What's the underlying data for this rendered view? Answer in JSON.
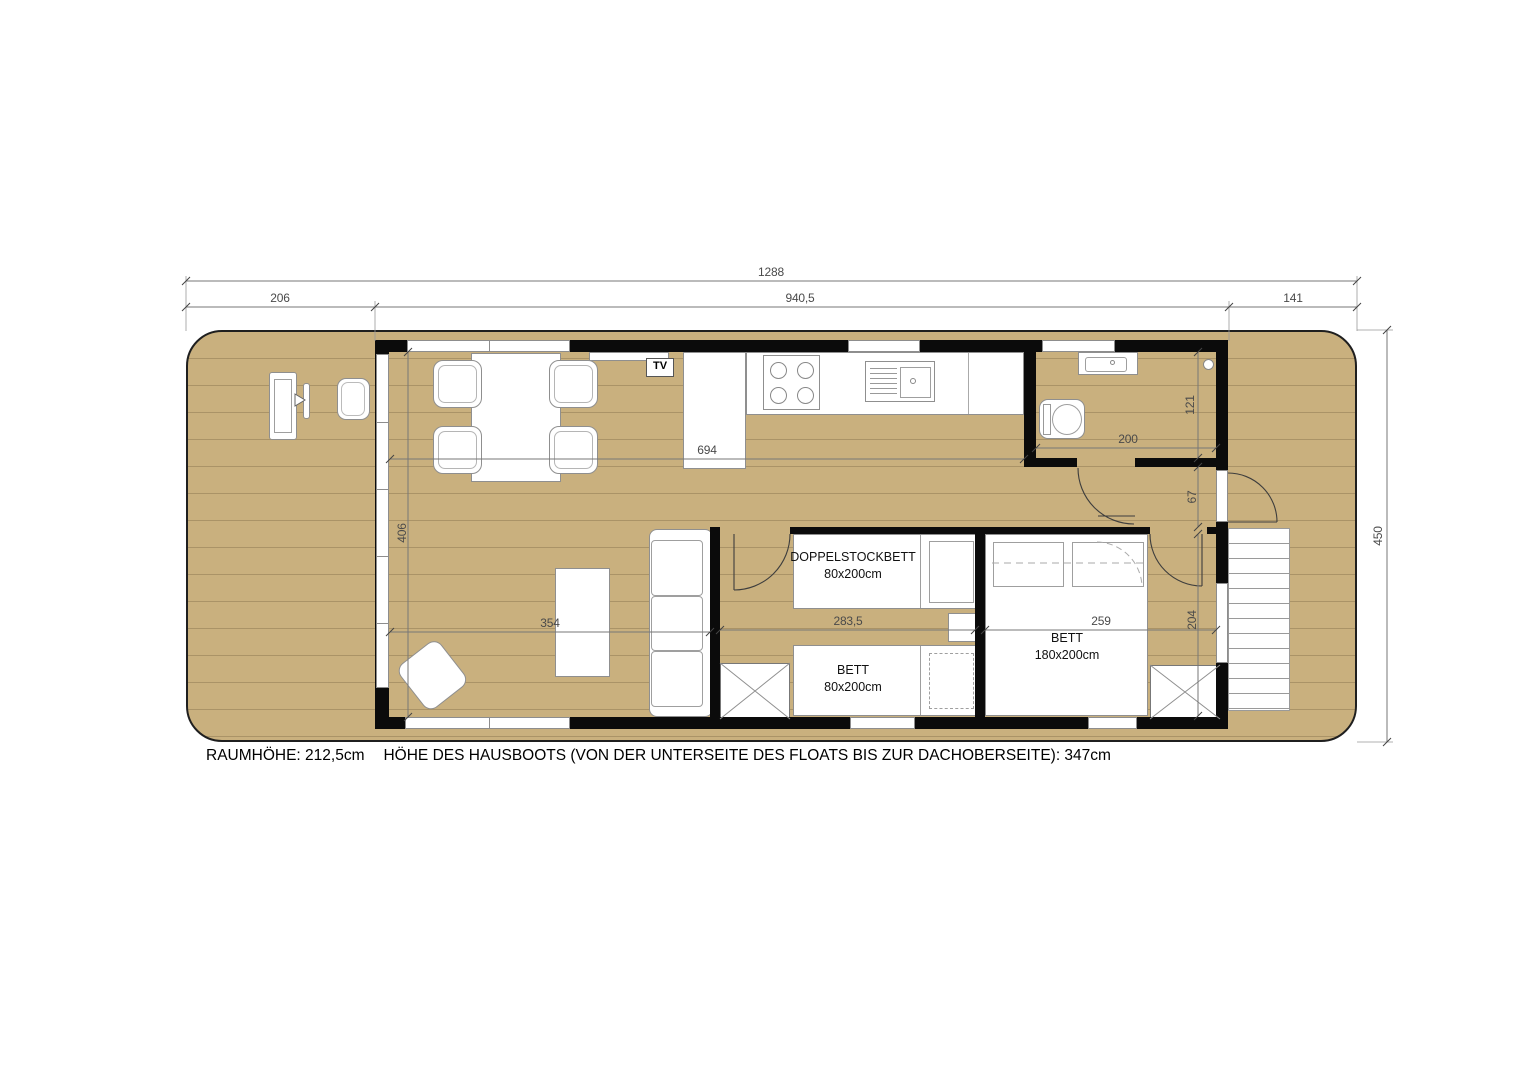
{
  "labels": {
    "tv": "TV"
  },
  "dims": {
    "hull_length": "1288",
    "front_deck": "206",
    "cabin_length": "940,5",
    "rear_deck": "141",
    "hull_width": "450",
    "kitchen_run": "694",
    "living_depth": "406",
    "living_width": "354",
    "kids_room_width": "283,5",
    "master_room_width": "259",
    "master_room_depth": "204",
    "hall_width": "67",
    "bath_depth": "121",
    "bath_width": "200"
  },
  "rooms": {
    "bunk_bed": {
      "line1": "DOPPELSTOCKBETT",
      "line2": "80x200cm"
    },
    "single_bed": {
      "line1": "BETT",
      "line2": "80x200cm"
    },
    "master_bed": {
      "line1": "BETT",
      "line2": "180x200cm"
    }
  },
  "footer": {
    "room_height": "RAUMHÖHE: 212,5cm",
    "boat_height": "HÖHE DES HAUSBOOTS (VON DER UNTERSEITE DES FLOATS BIS ZUR DACHOBERSEITE): 347cm"
  },
  "colors": {
    "deck": "#C9B07E",
    "deck_lines": "#A89263",
    "wall": "#0B0B0B",
    "furniture_outline": "#8F8F8F",
    "dimension_text": "#4A4A4A",
    "background": "#FFFFFF"
  }
}
